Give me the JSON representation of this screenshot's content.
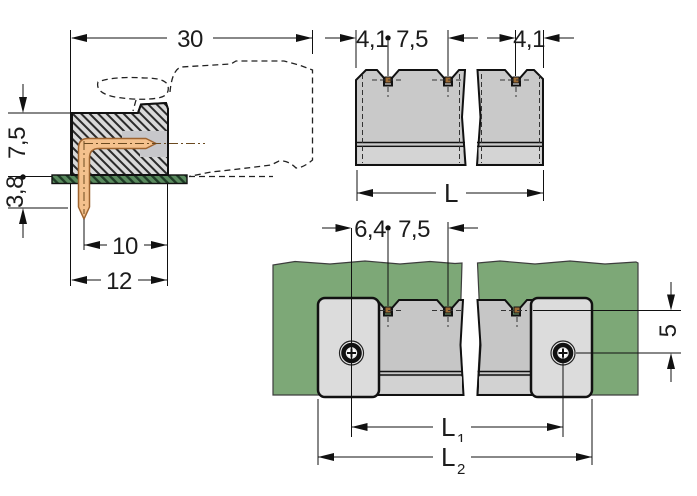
{
  "drawing": {
    "side_view": {
      "dim_total_depth": "30",
      "dim_height_above_board": "7,5",
      "dim_pin_below_board": "3,8",
      "dim_pin_to_face": "10",
      "dim_body_depth": "12"
    },
    "top_view": {
      "dim_edge_to_pin_left": "4,1",
      "dim_pin_pitch": "7,5",
      "dim_edge_to_pin_right": "4,1",
      "dim_total_length": "L"
    },
    "mounting_view": {
      "dim_screw_to_pin": "6,4",
      "dim_pin_pitch": "7,5",
      "dim_pin_row_to_screw": "5",
      "dim_screw_spacing_base": "L",
      "dim_screw_spacing_sub": "1",
      "dim_flange_spacing_base": "L",
      "dim_flange_spacing_sub": "2"
    },
    "colors": {
      "green_panel": "#7DA877",
      "pcb_green": "#5A8A5E",
      "body_gray": "#C9C9C9",
      "body_gray_dark": "#C6C6C6",
      "cavity_gray": "#C7C7CA",
      "flange_gray": "#DCDCDC",
      "light_strip": "#D4D4D4",
      "pin_copper": "#F4C18D",
      "pin_copper_dark": "#9C6B35",
      "line_black": "#111111"
    }
  }
}
